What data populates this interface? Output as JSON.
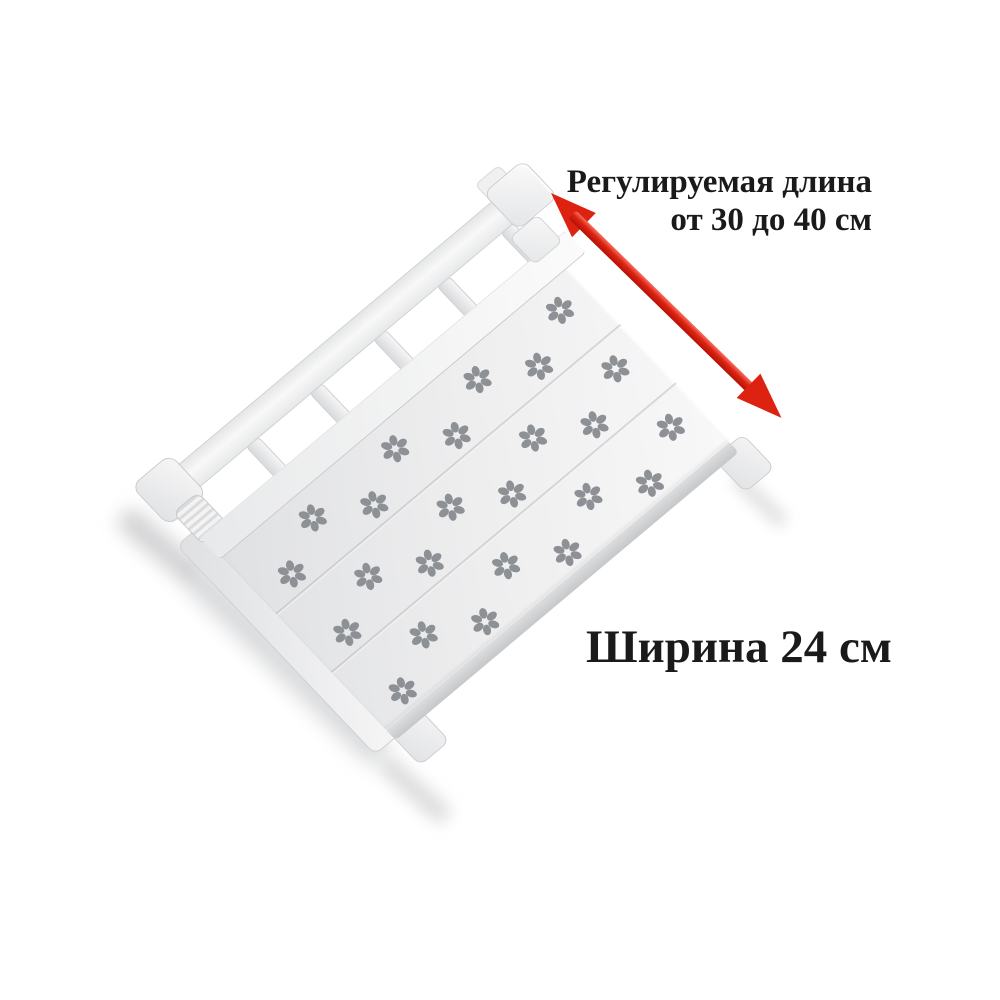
{
  "canvas": {
    "width_px": 1000,
    "height_px": 1000,
    "background": "#ffffff"
  },
  "annotations": {
    "length_note_line1": "Регулируемая длина",
    "length_note_line2": "от 30 до 40 см",
    "width_note": "Ширина 24 см",
    "text_color": "#1a1a1a"
  },
  "arrow": {
    "type": "double-headed",
    "meaning": "adjustable length direction",
    "color_dark": "#b31305",
    "color_main": "#dd2212",
    "color_light": "#f4715f"
  },
  "shelf": {
    "description": "white adjustable closet organizer shelf with flower-shaped perforations and sliding ladder rail",
    "surface_light": "#f8f8f9",
    "surface_mid": "#eeeeef",
    "surface_dark": "#dfe0e2",
    "edge_line": "#c7c8ca",
    "petal_color": "#8d9094",
    "sections": 3,
    "ladder_rungs": 5,
    "flower_rows": 8,
    "flower_even_row_x": [
      58,
      140,
      222
    ],
    "flower_odd_row_x": [
      88,
      170,
      252
    ],
    "flower_start_y": 35,
    "flower_spacing_y": 55,
    "rung_start_y": 8,
    "rung_spacing_y": 85,
    "icons": {
      "perforation": "flower-perforation-icon"
    }
  }
}
